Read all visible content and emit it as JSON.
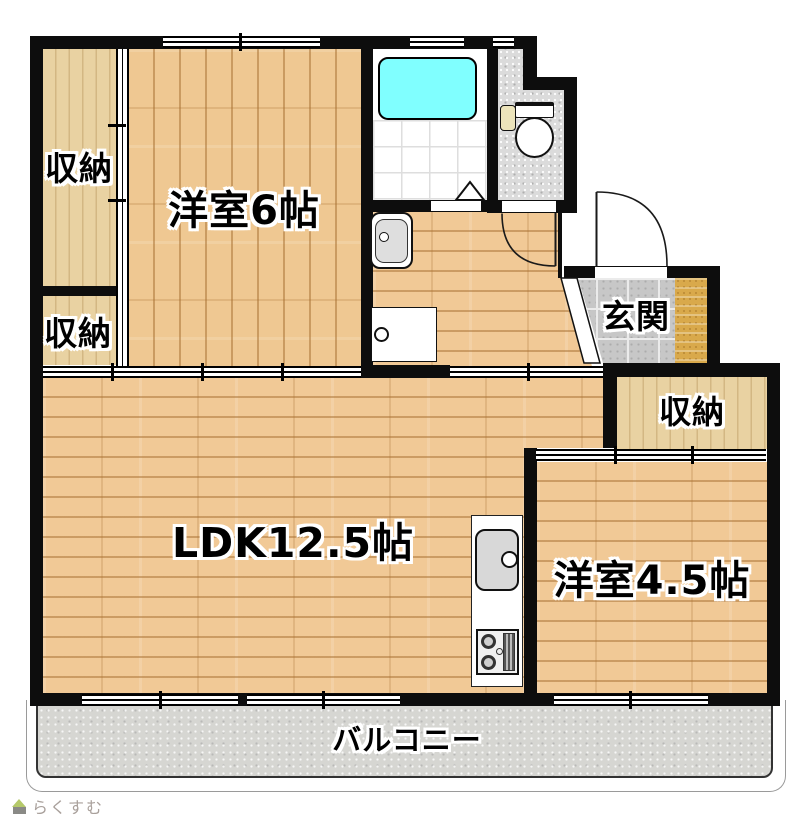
{
  "plan_title": "apartment-floor-plan",
  "rooms": {
    "western6": {
      "label": "洋室6帖",
      "floor": "wood-vertical-planks"
    },
    "ldk": {
      "label": "LDK12.5帖",
      "floor": "wood-horizontal-planks"
    },
    "western45": {
      "label": "洋室4.5帖",
      "floor": "wood-horizontal-planks"
    },
    "entrance": {
      "label": "玄関",
      "floor": "gray-stone-tile"
    },
    "balcony": {
      "label": "バルコニー",
      "floor": "concrete"
    },
    "closet_upper_left": {
      "label": "収納",
      "floor": "closet-wood"
    },
    "closet_lower_left": {
      "label": "収納",
      "floor": "closet-wood"
    },
    "closet_right": {
      "label": "収納",
      "floor": "closet-wood"
    },
    "bathroom": {
      "floor": "white-tile-grid"
    },
    "toilet_room": {
      "floor": "speckled-gray"
    },
    "hallway_washroom": {
      "floor": "wood-horizontal-planks"
    }
  },
  "fixtures": {
    "bathtub": "bathtub-icon",
    "toilet": "toilet-icon",
    "washbasin": "washbasin-icon",
    "washing_machine_pan": "washing-machine-pan-icon",
    "kitchen_sink": "kitchen-sink-icon",
    "gas_stove": "gas-stove-icon",
    "entry_door_swing": "door-swing-arc-icon",
    "toilet_door_swing": "door-swing-arc-icon",
    "bath_folding_door": "triangle-door-icon",
    "shoe_cabinet": "shoe-cabinet-icon"
  },
  "colors": {
    "wall": "#0d0d0d",
    "wood_floor": "#f1c996",
    "closet_wood": "#e9d2a2",
    "bathtub": "#80ffff",
    "entry_tile": "#c7c7c7",
    "toilet_floor": "#dbdbdb",
    "balcony_floor": "#d6d6d2",
    "shoe_cabinet": "#d9a94b"
  },
  "watermark": {
    "text": "らくすむ",
    "icon": "rakusumu-house-icon"
  }
}
